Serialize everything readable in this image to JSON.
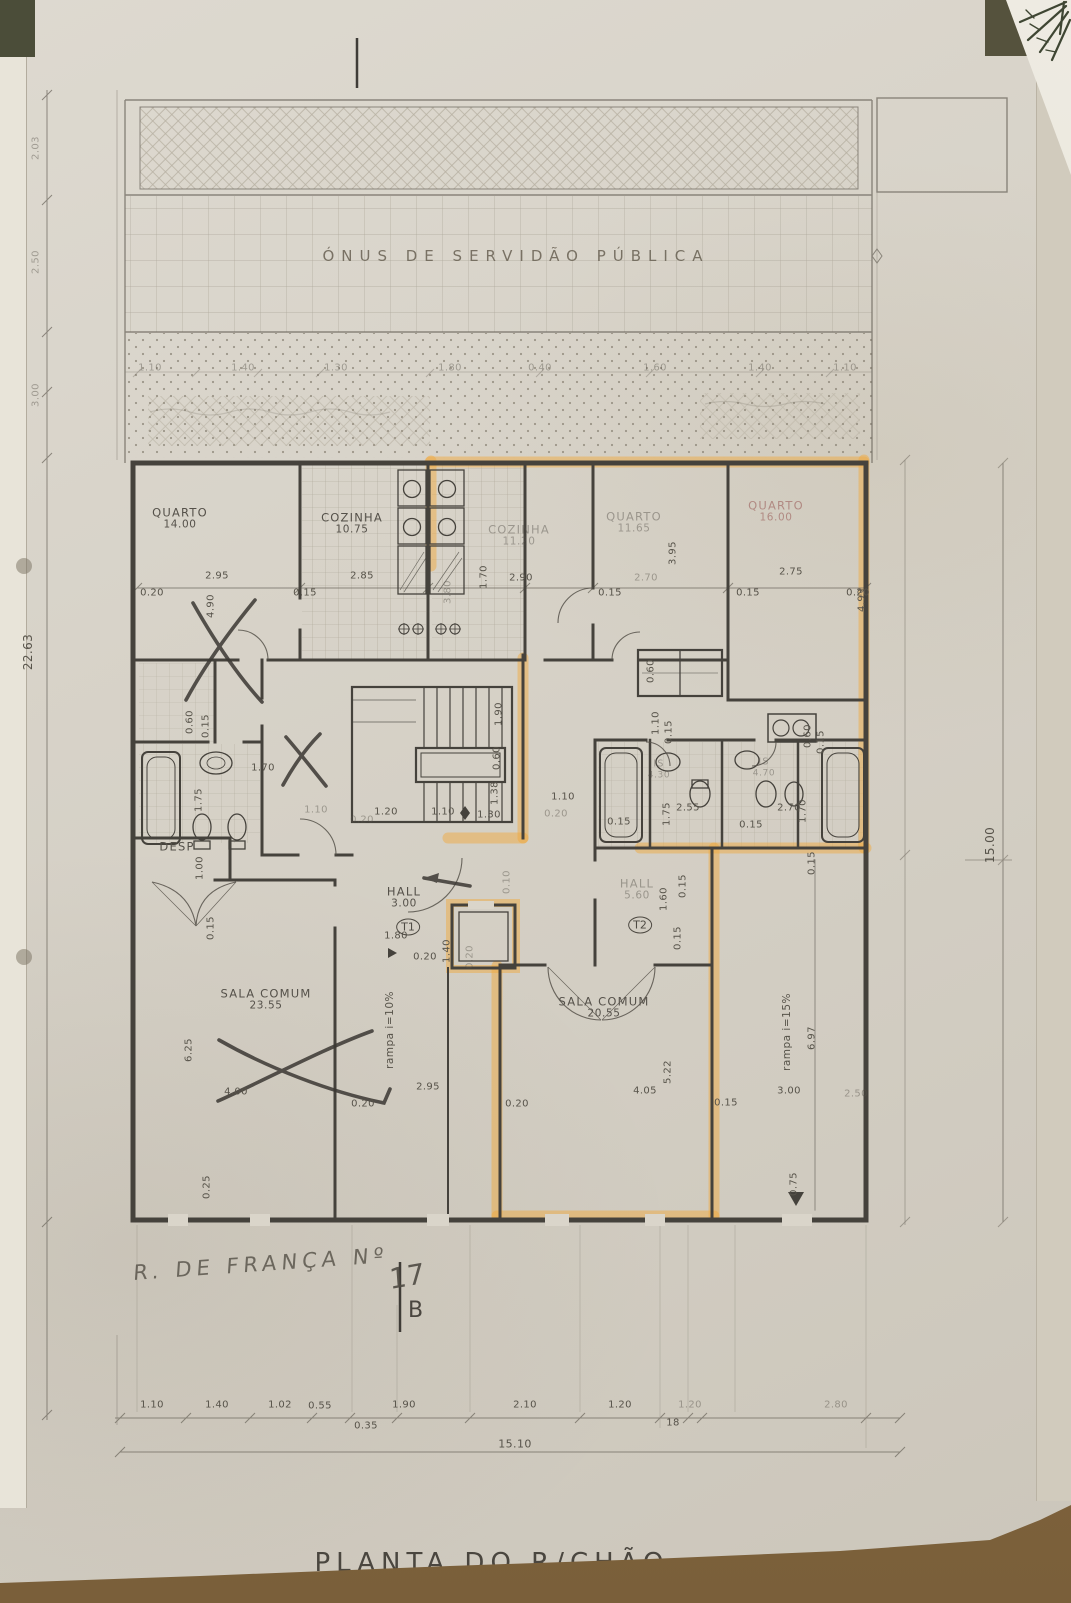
{
  "plan": {
    "easement_text": "ÓNUS DE SERVIDÃO PÚBLICA",
    "title": "PLANTA DO R/CHÃO",
    "street_note": "R. DE FRANÇA Nº",
    "street_number": "17",
    "section_marker": "B"
  },
  "colors": {
    "highlighter": "#f0a93c",
    "ink": "#45423c",
    "paper": "#d8d3c8",
    "table": "#8a6f4b"
  },
  "overall_dims": {
    "left_total": "22.63",
    "right_total": "15.00",
    "bottom_total": "15.10"
  },
  "rooms": [
    {
      "name": "QUARTO",
      "area": "14.00",
      "x": 180,
      "y": 519
    },
    {
      "name": "COZINHA",
      "area": "10.75",
      "x": 352,
      "y": 524
    },
    {
      "name": "COZINHA",
      "area": "11.20",
      "x": 519,
      "y": 536,
      "faint": 1
    },
    {
      "name": "QUARTO",
      "area": "11.65",
      "x": 634,
      "y": 523,
      "faint": 1
    },
    {
      "name": "QUARTO",
      "area": "16.00",
      "x": 776,
      "y": 512,
      "tint": 1
    },
    {
      "name": "DESP",
      "x": 177,
      "y": 847
    },
    {
      "name": "HALL",
      "area": "3.00",
      "x": 404,
      "y": 898
    },
    {
      "name": "HALL",
      "area": "5.60",
      "x": 637,
      "y": 890,
      "faint": 1
    },
    {
      "name": "SALA COMUM",
      "area": "23.55",
      "x": 266,
      "y": 1000
    },
    {
      "name": "SALA COMUM",
      "area": "20.55",
      "x": 604,
      "y": 1008
    },
    {
      "name": "IS",
      "area": "4.30",
      "x": 659,
      "y": 770,
      "faint": 1,
      "small": 1
    },
    {
      "name": "IS",
      "area": "4.70",
      "x": 764,
      "y": 768,
      "faint": 1,
      "small": 1
    }
  ],
  "unit_markers": [
    {
      "t": "T1",
      "x": 408,
      "y": 927
    },
    {
      "t": "T2",
      "x": 640,
      "y": 925
    }
  ],
  "ramps": [
    {
      "t": "rampa i=10%",
      "x": 390,
      "y": 1030
    },
    {
      "t": "rampa i=15%",
      "x": 787,
      "y": 1032
    }
  ],
  "dimensions": [
    [
      "1.10",
      150,
      368,
      0,
      1
    ],
    [
      "1.40",
      243,
      368,
      0,
      1
    ],
    [
      "1.30",
      336,
      368,
      0,
      1
    ],
    [
      "1.80",
      450,
      368,
      0,
      1
    ],
    [
      "0.40",
      540,
      368,
      0,
      1
    ],
    [
      "1.60",
      655,
      368,
      0,
      1
    ],
    [
      "1.40",
      760,
      368,
      0,
      1
    ],
    [
      "1.10",
      845,
      368,
      0,
      1
    ],
    [
      "2.03",
      36,
      148,
      -90,
      1
    ],
    [
      "2.50",
      36,
      262,
      -90,
      1
    ],
    [
      "3.00",
      36,
      395,
      -90,
      1
    ],
    [
      "22.63",
      28,
      652,
      -90,
      0,
      12
    ],
    [
      "15.00",
      990,
      845,
      -90,
      0,
      12
    ],
    [
      "15.10",
      515,
      1444,
      0,
      0,
      11
    ],
    [
      "0.20",
      152,
      593
    ],
    [
      "2.95",
      217,
      576
    ],
    [
      "4.90",
      211,
      606,
      -90
    ],
    [
      "0.15",
      305,
      593
    ],
    [
      "2.85",
      362,
      576
    ],
    [
      "3.80",
      448,
      592,
      -90,
      1
    ],
    [
      "1.70",
      484,
      577,
      -90
    ],
    [
      "2.90",
      521,
      578
    ],
    [
      "0.15",
      610,
      593
    ],
    [
      "2.70",
      646,
      578,
      0,
      1
    ],
    [
      "3.95",
      673,
      553,
      -90
    ],
    [
      "0.15",
      748,
      593
    ],
    [
      "2.75",
      791,
      572
    ],
    [
      "0.20",
      858,
      593
    ],
    [
      "4.93",
      862,
      600,
      -90
    ],
    [
      "0.60",
      190,
      722,
      -90
    ],
    [
      "0.15",
      206,
      726,
      -90
    ],
    [
      "1.70",
      263,
      768
    ],
    [
      "1.75",
      199,
      800,
      -90
    ],
    [
      "1.10",
      316,
      810,
      0,
      1
    ],
    [
      "1.00",
      200,
      868,
      -90
    ],
    [
      "0.15",
      211,
      928,
      -90
    ],
    [
      "1.90",
      499,
      714,
      -90
    ],
    [
      "0.60",
      497,
      758,
      -90
    ],
    [
      "1.38",
      495,
      793,
      -90
    ],
    [
      "1.20",
      386,
      812
    ],
    [
      "1.10",
      443,
      812
    ],
    [
      "1.30",
      489,
      815
    ],
    [
      "0.20",
      362,
      820,
      0,
      1
    ],
    [
      "1.10",
      563,
      797
    ],
    [
      "0.20",
      556,
      814,
      0,
      1
    ],
    [
      "0.10",
      507,
      882,
      -90,
      1
    ],
    [
      "0.60",
      651,
      671,
      -90
    ],
    [
      "1.10",
      656,
      723,
      -90
    ],
    [
      "0.15",
      669,
      732,
      -90
    ],
    [
      "0.60",
      808,
      736,
      -90
    ],
    [
      "0.15",
      821,
      742,
      -90
    ],
    [
      "2.55",
      688,
      808
    ],
    [
      "1.75",
      667,
      814,
      -90
    ],
    [
      "0.15",
      619,
      822
    ],
    [
      "0.15",
      751,
      825
    ],
    [
      "2.70",
      789,
      808
    ],
    [
      "1.70",
      803,
      811,
      -90
    ],
    [
      "1.80",
      396,
      936
    ],
    [
      "0.20",
      425,
      957
    ],
    [
      "1.40",
      447,
      951,
      -90
    ],
    [
      "0.20",
      470,
      957,
      -90,
      1
    ],
    [
      "1.60",
      664,
      899,
      -90
    ],
    [
      "0.15",
      683,
      886,
      -90
    ],
    [
      "0.15",
      678,
      938,
      -90
    ],
    [
      "6.25",
      189,
      1050,
      -90
    ],
    [
      "4.00",
      236,
      1092
    ],
    [
      "2.95",
      428,
      1087
    ],
    [
      "0.20",
      363,
      1104
    ],
    [
      "0.25",
      207,
      1187,
      -90
    ],
    [
      "5.22",
      668,
      1072,
      -90
    ],
    [
      "4.05",
      645,
      1091
    ],
    [
      "0.20",
      517,
      1104
    ],
    [
      "0.15",
      726,
      1103
    ],
    [
      "3.00",
      789,
      1091
    ],
    [
      "2.50",
      856,
      1094,
      0,
      1
    ],
    [
      "6.97",
      812,
      1038,
      -90
    ],
    [
      "0.15",
      812,
      863,
      -90
    ],
    [
      "0.75",
      794,
      1184,
      -90
    ],
    [
      "1.10",
      152,
      1405
    ],
    [
      "1.40",
      217,
      1405
    ],
    [
      "1.02",
      280,
      1405
    ],
    [
      "0.55",
      320,
      1406
    ],
    [
      "1.90",
      404,
      1405
    ],
    [
      "2.10",
      525,
      1405
    ],
    [
      "1.20",
      620,
      1405
    ],
    [
      "1.20",
      690,
      1405,
      0,
      1
    ],
    [
      "2.80",
      836,
      1405,
      0,
      1
    ],
    [
      "0.35",
      366,
      1426
    ],
    [
      "18",
      673,
      1423
    ]
  ]
}
